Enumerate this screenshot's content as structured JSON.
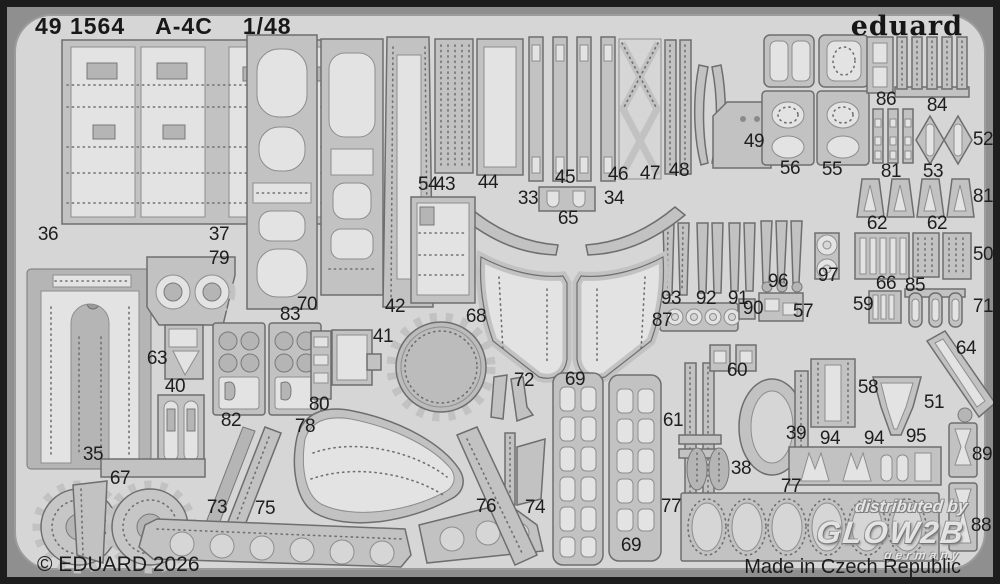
{
  "header": {
    "catalog": "49 1564",
    "kit": "A-4C",
    "scale": "1/48",
    "brand": "eduard"
  },
  "footer": {
    "copyright": "© EDUARD 2026",
    "made_in": "Made in Czech Republic"
  },
  "watermark": {
    "line1": "distributed by",
    "line2": "GLOW2B",
    "line3": "germany"
  },
  "colors": {
    "sheet": "#d6d6d6",
    "part_fill": "#c2c2c2",
    "part_outline": "#6e6e6e",
    "etched_light": "#e3e3e3",
    "frame": "#1d1d1d",
    "corner_gap": "#8f8f8f",
    "text": "#1c1c1c"
  },
  "parts": [
    {
      "n": "36",
      "x": 41,
      "y": 228
    },
    {
      "n": "37",
      "x": 212,
      "y": 228
    },
    {
      "n": "79",
      "x": 212,
      "y": 252
    },
    {
      "n": "63",
      "x": 150,
      "y": 352
    },
    {
      "n": "40",
      "x": 168,
      "y": 380
    },
    {
      "n": "35",
      "x": 86,
      "y": 448
    },
    {
      "n": "67",
      "x": 113,
      "y": 472
    },
    {
      "n": "82",
      "x": 224,
      "y": 414
    },
    {
      "n": "73",
      "x": 210,
      "y": 501
    },
    {
      "n": "75",
      "x": 258,
      "y": 502
    },
    {
      "n": "70",
      "x": 300,
      "y": 298
    },
    {
      "n": "83",
      "x": 283,
      "y": 308
    },
    {
      "n": "80",
      "x": 312,
      "y": 398
    },
    {
      "n": "78",
      "x": 298,
      "y": 420
    },
    {
      "n": "42",
      "x": 388,
      "y": 300
    },
    {
      "n": "41",
      "x": 376,
      "y": 330
    },
    {
      "n": "54",
      "x": 421,
      "y": 178
    },
    {
      "n": "43",
      "x": 438,
      "y": 178
    },
    {
      "n": "44",
      "x": 481,
      "y": 176
    },
    {
      "n": "45",
      "x": 558,
      "y": 171
    },
    {
      "n": "46",
      "x": 611,
      "y": 168
    },
    {
      "n": "47",
      "x": 643,
      "y": 167
    },
    {
      "n": "48",
      "x": 672,
      "y": 164
    },
    {
      "n": "33",
      "x": 521,
      "y": 192
    },
    {
      "n": "34",
      "x": 607,
      "y": 192
    },
    {
      "n": "65",
      "x": 561,
      "y": 212
    },
    {
      "n": "68",
      "x": 469,
      "y": 310
    },
    {
      "n": "72",
      "x": 517,
      "y": 374
    },
    {
      "n": "69",
      "x": 568,
      "y": 373
    },
    {
      "n": "69",
      "x": 624,
      "y": 539
    },
    {
      "n": "76",
      "x": 479,
      "y": 500
    },
    {
      "n": "74",
      "x": 528,
      "y": 501
    },
    {
      "n": "77",
      "x": 664,
      "y": 500
    },
    {
      "n": "77",
      "x": 784,
      "y": 480
    },
    {
      "n": "38",
      "x": 734,
      "y": 462
    },
    {
      "n": "39",
      "x": 789,
      "y": 427
    },
    {
      "n": "94",
      "x": 823,
      "y": 432
    },
    {
      "n": "94",
      "x": 867,
      "y": 432
    },
    {
      "n": "95",
      "x": 909,
      "y": 430
    },
    {
      "n": "58",
      "x": 861,
      "y": 381
    },
    {
      "n": "51",
      "x": 927,
      "y": 396
    },
    {
      "n": "61",
      "x": 666,
      "y": 414
    },
    {
      "n": "60",
      "x": 730,
      "y": 364
    },
    {
      "n": "89",
      "x": 975,
      "y": 448
    },
    {
      "n": "88",
      "x": 974,
      "y": 519
    },
    {
      "n": "64",
      "x": 959,
      "y": 342
    },
    {
      "n": "57",
      "x": 796,
      "y": 305
    },
    {
      "n": "90",
      "x": 746,
      "y": 302
    },
    {
      "n": "91",
      "x": 731,
      "y": 292
    },
    {
      "n": "92",
      "x": 699,
      "y": 292
    },
    {
      "n": "93",
      "x": 664,
      "y": 292
    },
    {
      "n": "87",
      "x": 655,
      "y": 314
    },
    {
      "n": "59",
      "x": 856,
      "y": 298
    },
    {
      "n": "66",
      "x": 879,
      "y": 277
    },
    {
      "n": "85",
      "x": 908,
      "y": 279
    },
    {
      "n": "96",
      "x": 771,
      "y": 275
    },
    {
      "n": "97",
      "x": 821,
      "y": 269
    },
    {
      "n": "50",
      "x": 976,
      "y": 248
    },
    {
      "n": "71",
      "x": 976,
      "y": 300
    },
    {
      "n": "62",
      "x": 870,
      "y": 217
    },
    {
      "n": "62",
      "x": 930,
      "y": 217
    },
    {
      "n": "81",
      "x": 976,
      "y": 190
    },
    {
      "n": "52",
      "x": 976,
      "y": 133
    },
    {
      "n": "81",
      "x": 884,
      "y": 165
    },
    {
      "n": "53",
      "x": 926,
      "y": 165
    },
    {
      "n": "55",
      "x": 825,
      "y": 163
    },
    {
      "n": "56",
      "x": 783,
      "y": 162
    },
    {
      "n": "49",
      "x": 747,
      "y": 135
    },
    {
      "n": "86",
      "x": 879,
      "y": 93
    },
    {
      "n": "84",
      "x": 930,
      "y": 99
    }
  ]
}
